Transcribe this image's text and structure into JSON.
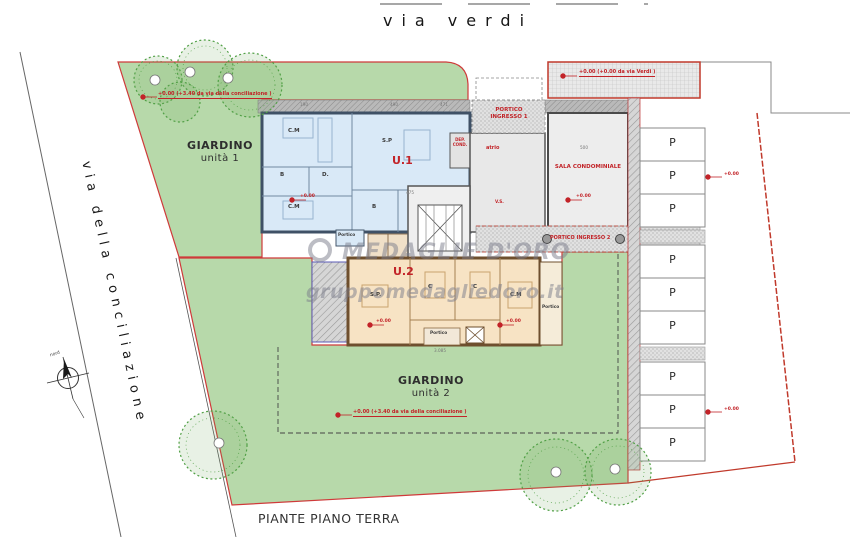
{
  "streets": {
    "top_label": "via verdi",
    "left_label": "via della conciliazione"
  },
  "plan": {
    "title": "PIANTE PIANO TERRA",
    "compass_label": "nord"
  },
  "watermark": {
    "brand": "MEDAGLIE D'ORO",
    "site": "gruppomedagliedoro.it"
  },
  "garden1": {
    "name": "GIARDINO",
    "unit": "unità 1",
    "elevation_note": "+0.00 (+3.40 da via della conciliazione )"
  },
  "garden2": {
    "name": "GIARDINO",
    "unit": "unità 2",
    "elevation_note": "+0.00 (+3.40 da via della conciliazione )"
  },
  "unit1": {
    "id": "U.1",
    "rooms": {
      "cm1": "C.M",
      "b1": "B",
      "d": "D.",
      "sp": "S.P",
      "cm2": "C.M",
      "b2": "B",
      "portico": "Portico"
    }
  },
  "unit2": {
    "id": "U.2",
    "rooms": {
      "sp": "S.P.",
      "c1": "C",
      "c2": "C",
      "cm": "C.M",
      "portico_bottom": "Portico",
      "portico_right": "Portico"
    }
  },
  "common": {
    "portico_ingresso_1": "PORTICO INGRESSO 1",
    "portico_ingresso_2": "PORTICO INGRESSO 2",
    "atrio": "atrio",
    "dep_cond": "DEP. COND.",
    "sala_condominiale": "SALA CONDOMINIALE",
    "vano_scala": "V.S."
  },
  "parking": {
    "stall_label": "P",
    "stall_count": 9
  },
  "elevations": {
    "zero": "+0.00",
    "via_verdi_note": "+0.00 (+0.00 da via Verdi )"
  },
  "dimensions": {
    "d1": "190",
    "d2": "490",
    "d3": "471",
    "d4": "475",
    "d5": "500",
    "d6": "3.085"
  }
}
